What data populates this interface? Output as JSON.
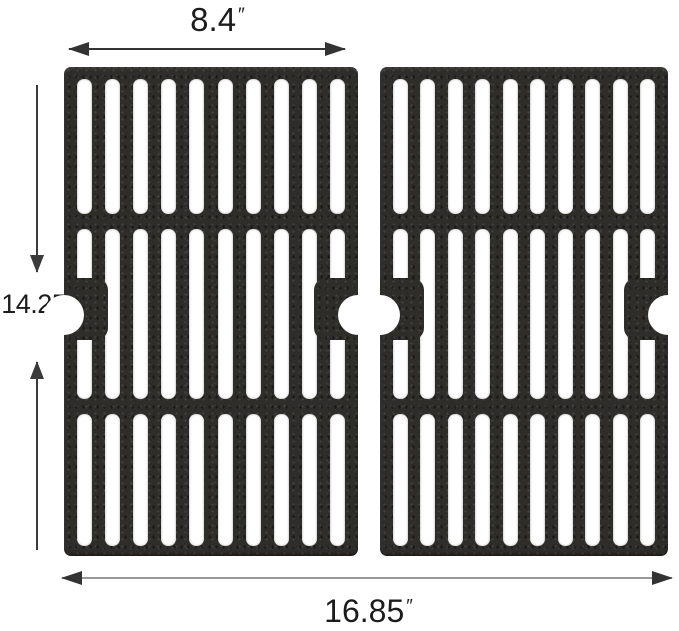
{
  "diagram": {
    "name": "cast-iron-grill-grates-dimension-diagram",
    "dimensions": {
      "panel_width": {
        "value": "8.4",
        "unit": "″"
      },
      "panel_height": {
        "value": "14.25",
        "unit": "″"
      },
      "total_width": {
        "value": "16.85",
        "unit": "″"
      }
    },
    "grates": {
      "panel_count": 2,
      "slot_columns": 10,
      "slot_rows": 3,
      "edge_notches_per_panel": 2
    },
    "colors": {
      "iron": "#2e2d2a",
      "slot": "#ffffff",
      "dimension_dark": "#333333",
      "dimension_gray": "#999999",
      "text": "#1c1c1c"
    }
  }
}
